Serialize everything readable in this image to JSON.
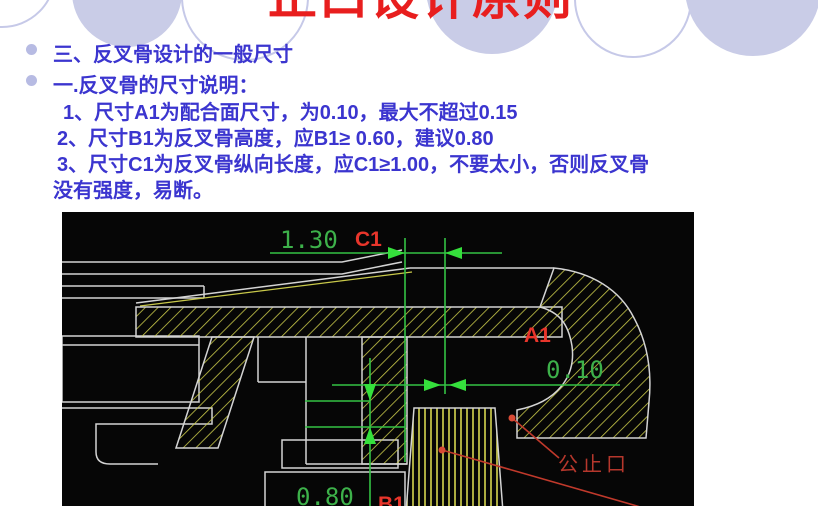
{
  "slide": {
    "title": "止口设计原则",
    "bullets": [
      "三、反叉骨设计的一般尺寸",
      "一.反叉骨的尺寸说明："
    ],
    "notes": [
      "1、尺寸A1为配合面尺寸，为0.10，最大不超过0.15",
      "2、尺寸B1为反叉骨高度，应B1≥ 0.60，建议0.80",
      "3、尺寸C1为反叉骨纵向长度，应C1≥1.00，不要太小，否则反叉骨",
      "没有强度，易断。"
    ],
    "colors": {
      "title_red": "#e81e1e",
      "body_blue": "#3b35cf",
      "circle_lavender": "#c9cce7"
    }
  },
  "cad": {
    "dims": {
      "c1": {
        "label": "C1",
        "value": "1.30"
      },
      "a1": {
        "label": "A1",
        "value": "0.10"
      },
      "b1": {
        "label": "B1",
        "value": "0.80"
      }
    },
    "callout": "公止口",
    "colors": {
      "background": "#060606",
      "line_green": "#33c244",
      "label_red": "#e8352b",
      "hatch_yellow": "#c9c94a",
      "outline_gray": "#d4d4d4"
    }
  }
}
